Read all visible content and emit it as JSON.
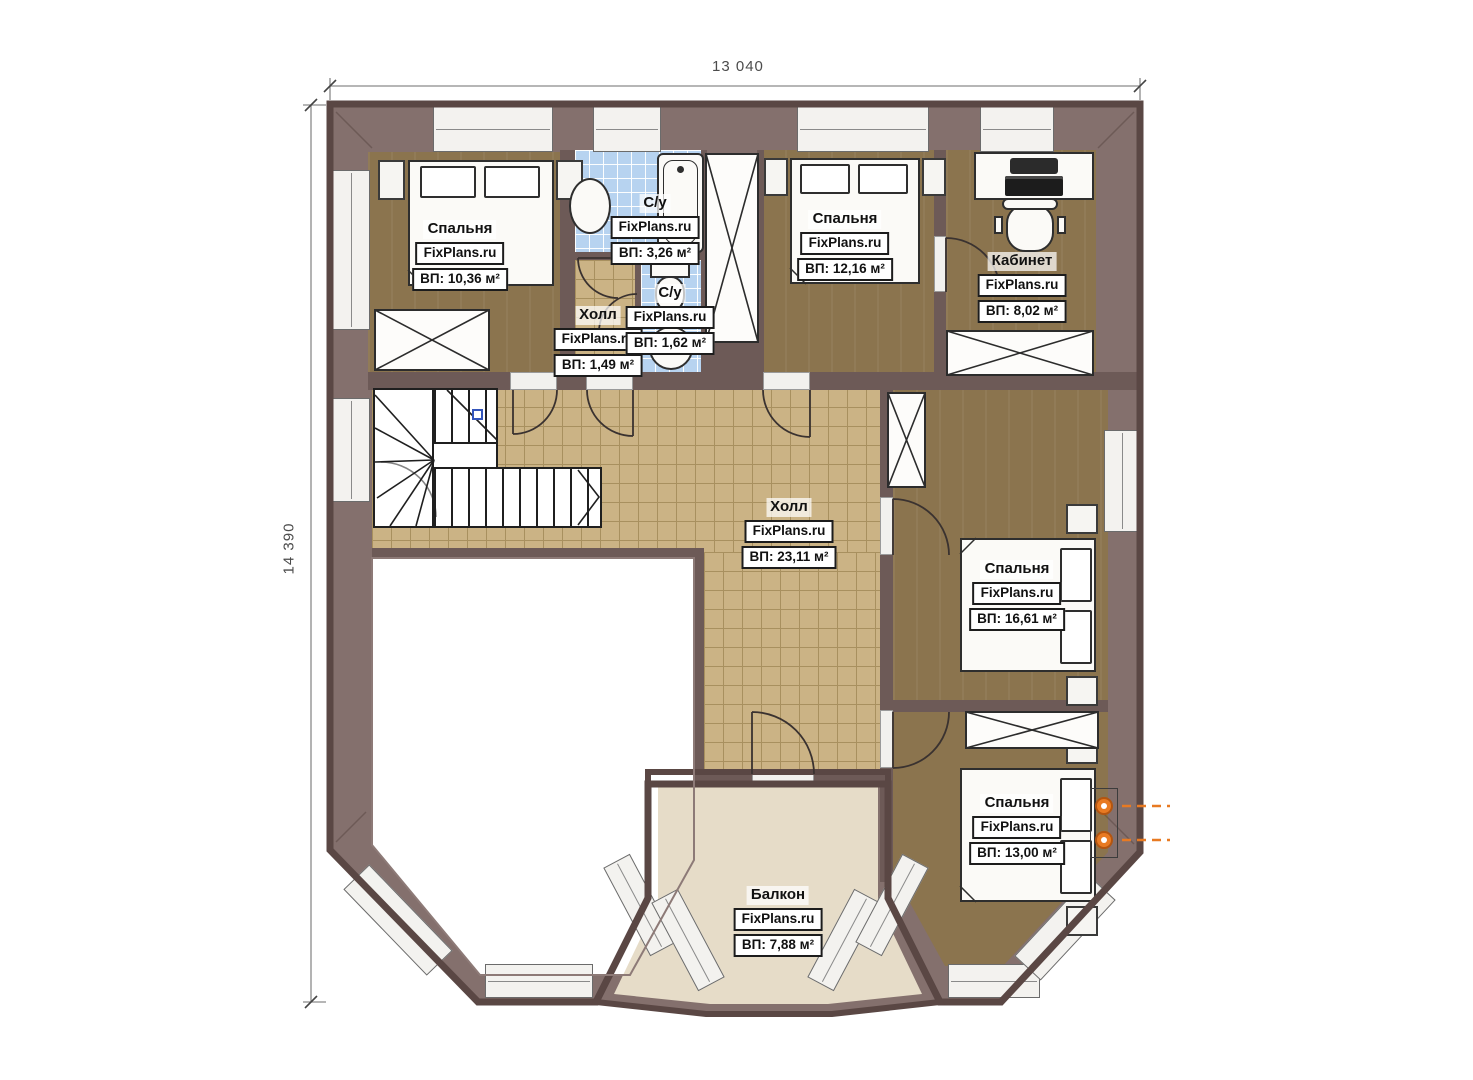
{
  "plan_title": "Floor plan — second floor",
  "brand": "FixPlans.ru",
  "dimensions": {
    "top": "13 040",
    "left": "14 390"
  },
  "rooms": [
    {
      "id": "bedroom-1",
      "name": "Спальня",
      "brand": "FixPlans.ru",
      "area": "ВП: 10,36 м²"
    },
    {
      "id": "bathroom-1",
      "name": "С/у",
      "brand": "FixPlans.ru",
      "area": "ВП: 3,26 м²"
    },
    {
      "id": "hall-small",
      "name": "Холл",
      "brand": "FixPlans.ru",
      "area": "ВП: 1,49 м²"
    },
    {
      "id": "bathroom-2",
      "name": "С/у",
      "brand": "FixPlans.ru",
      "area": "ВП: 1,62 м²"
    },
    {
      "id": "bedroom-2",
      "name": "Спальня",
      "brand": "FixPlans.ru",
      "area": "ВП: 12,16 м²"
    },
    {
      "id": "office",
      "name": "Кабинет",
      "brand": "FixPlans.ru",
      "area": "ВП: 8,02 м²"
    },
    {
      "id": "hall-main",
      "name": "Холл",
      "brand": "FixPlans.ru",
      "area": "ВП: 23,11 м²"
    },
    {
      "id": "bedroom-3",
      "name": "Спальня",
      "brand": "FixPlans.ru",
      "area": "ВП: 16,61 м²"
    },
    {
      "id": "bedroom-4",
      "name": "Спальня",
      "brand": "FixPlans.ru",
      "area": "ВП: 13,00 м²"
    },
    {
      "id": "balcony",
      "name": "Балкон",
      "brand": "FixPlans.ru",
      "area": "ВП: 7,88 м²"
    }
  ],
  "colors": {
    "wall_dark": "#67534f",
    "wall_band": "#84706d",
    "floor_wood": "#8b744e",
    "floor_tile": "#cbb385",
    "floor_bath": "#b7d3f0",
    "floor_balcony": "#e6dcc8",
    "lamp_accent": "#e87a22"
  },
  "icons": [
    "bed-icon",
    "bathtub-icon",
    "sink-icon",
    "toilet-icon",
    "desk-laptop-icon",
    "office-chair-icon",
    "stairs-icon",
    "wall-lamp-icon",
    "wardrobe-icon"
  ]
}
